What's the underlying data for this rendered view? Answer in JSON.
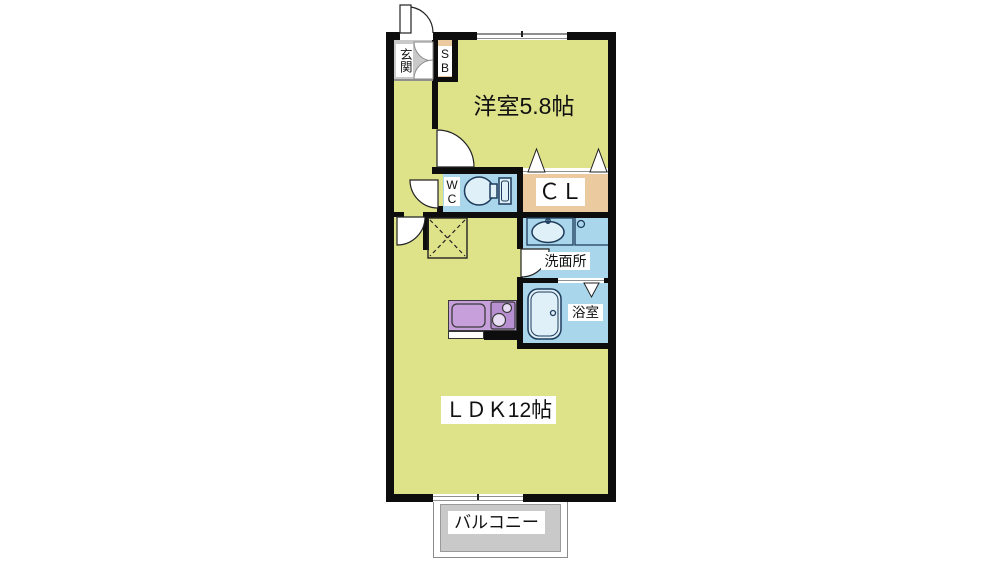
{
  "floorplan": {
    "labels": {
      "entrance": "玄関",
      "shoe_box": "SB",
      "western_room": "洋室5.8帖",
      "wc": "WC",
      "closet": "ＣＬ",
      "washroom": "洗面所",
      "bathroom": "浴室",
      "ldk": "ＬＤＫ12帖",
      "balcony": "バルコニー"
    },
    "colors": {
      "floor_yellow": "#dee289",
      "wet_blue": "#a9d6ea",
      "storage_tan": "#ecca9f",
      "kitchen_purple": "#c79fdb",
      "entrance_gray": "#c9c9c9",
      "balcony_gray": "#c9c9c9",
      "wall_black": "#0d0d0d",
      "fixture_outline": "#1e3c5c"
    }
  }
}
